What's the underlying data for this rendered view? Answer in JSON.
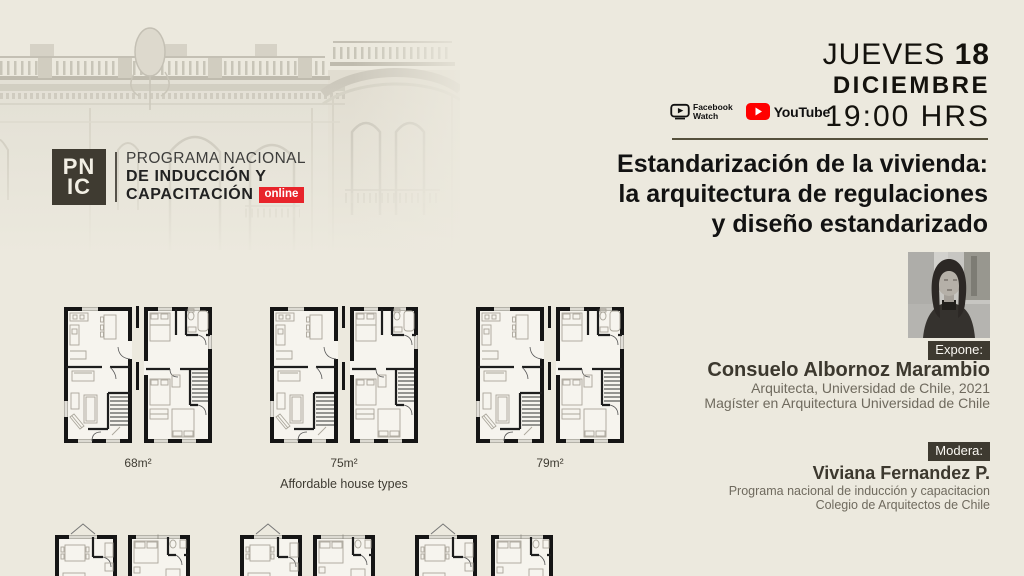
{
  "logo": {
    "acronym_line1": "PN",
    "acronym_line2": "IC",
    "line1": "PROGRAMA NACIONAL",
    "line2": "DE INDUCCIÓN Y",
    "line3": "CAPACITACIÓN",
    "online_badge": "online"
  },
  "event": {
    "day_label": "JUEVES",
    "day_number": "18",
    "month": "DICIEMBRE",
    "time": "19:00 HRS",
    "title_line1": "Estandarización de la vivienda:",
    "title_line2": "la arquitectura de regulaciones",
    "title_line3": "y diseño estandarizado"
  },
  "platforms": {
    "facebook_line1": "Facebook",
    "facebook_line2": "Watch",
    "youtube": "YouTube"
  },
  "speaker": {
    "role_badge": "Expone:",
    "name": "Consuelo Albornoz Marambio",
    "credential1": "Arquitecta, Universidad de Chile, 2021",
    "credential2": "Magíster en Arquitectura Universidad de Chile"
  },
  "moderator": {
    "role_badge": "Modera:",
    "name": "Viviana Fernandez P.",
    "affiliation1": "Programa nacional de inducción y capacitacion",
    "affiliation2": "Colegio de Arquitectos de Chile"
  },
  "plans": {
    "labels": [
      "68m²",
      "75m²",
      "79m²"
    ],
    "caption": "Affordable house types"
  },
  "colors": {
    "background": "#ece9de",
    "accent_red": "#e8242b",
    "badge_dark": "#3e3a30",
    "text_dark": "#14120d",
    "text_gray": "#6f6a5e",
    "youtube_red": "#ff0000"
  }
}
